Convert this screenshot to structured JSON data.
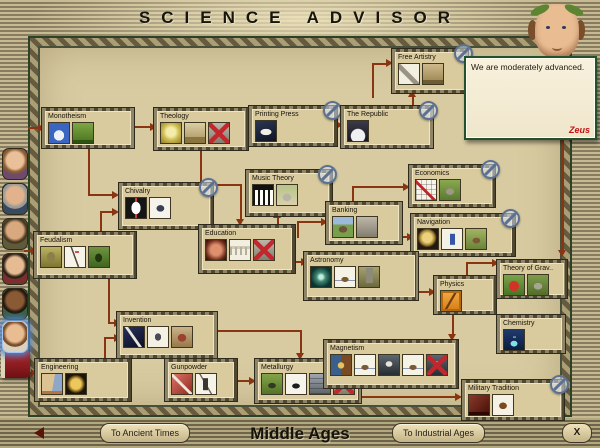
{
  "title": "SCIENCE ADVISOR",
  "era": {
    "current": "Middle Ages",
    "prev_button": "To Ancient Times",
    "next_button": "To Industrial Ages",
    "close_button": "X"
  },
  "advisor": {
    "message": "We are moderately advanced.",
    "link": "Zeus",
    "portrait": "science-advisor-with-laurel-wreath"
  },
  "colors": {
    "arrow": "#8a3512",
    "parchment": "#d8cba1",
    "trim_green": "#2c4226",
    "optional_badge": "#5c7191",
    "link_red": "#c31414"
  },
  "sidebar": {
    "advisors": [
      {
        "name": "domestic-advisor-portrait",
        "y": 148,
        "style": "p1",
        "selected": false
      },
      {
        "name": "trade-advisor-portrait",
        "y": 183,
        "style": "p2",
        "selected": false
      },
      {
        "name": "military-advisor-portrait",
        "y": 218,
        "style": "p3",
        "selected": false
      },
      {
        "name": "foreign-advisor-portrait",
        "y": 253,
        "style": "p4",
        "selected": false
      },
      {
        "name": "cultural-advisor-portrait",
        "y": 288,
        "style": "p5",
        "selected": false
      },
      {
        "name": "science-advisor-portrait",
        "y": 321,
        "style": "p6",
        "selected": true
      }
    ],
    "civilopedia_icon": "red-book-icon"
  },
  "techs": [
    {
      "id": "monotheism",
      "label": "Monotheism",
      "x": 42,
      "y": 108,
      "w": 92,
      "h": 40,
      "optional": false,
      "icons": [
        {
          "n": "cathedral-icon",
          "s": "ic-cathedral"
        },
        {
          "n": "knight-unit-icon",
          "s": "ic-knightg"
        }
      ]
    },
    {
      "id": "theology",
      "label": "Theology",
      "x": 154,
      "y": 108,
      "w": 94,
      "h": 42,
      "optional": false,
      "icons": [
        {
          "n": "statue-icon",
          "s": "ic-statue"
        },
        {
          "n": "sistine-chapel-icon",
          "s": "ic-chapel"
        },
        {
          "n": "unavailable-wonder-icon",
          "s": "ic-gray",
          "x": true
        }
      ]
    },
    {
      "id": "printing-press",
      "label": "Printing Press",
      "x": 249,
      "y": 106,
      "w": 88,
      "h": 40,
      "optional": true,
      "icons": [
        {
          "n": "printing-press-icon",
          "s": "ic-dove"
        }
      ]
    },
    {
      "id": "the-republic",
      "label": "The Republic",
      "x": 341,
      "y": 106,
      "w": 92,
      "h": 42,
      "optional": true,
      "icons": [
        {
          "n": "republic-building-icon",
          "s": "ic-dome"
        }
      ]
    },
    {
      "id": "free-artistry",
      "label": "Free Artistry",
      "x": 392,
      "y": 49,
      "w": 76,
      "h": 44,
      "optional": true,
      "icons": [
        {
          "n": "quill-icon",
          "s": "ic-quillw"
        },
        {
          "n": "theatre-icon",
          "s": "ic-theatre"
        }
      ]
    },
    {
      "id": "chivalry",
      "label": "Chivalry",
      "x": 119,
      "y": 183,
      "w": 94,
      "h": 46,
      "optional": true,
      "icons": [
        {
          "n": "heraldic-shield-icon",
          "s": "ic-shield"
        },
        {
          "n": "knight-horse-icon",
          "s": "ic-horse"
        }
      ]
    },
    {
      "id": "music-theory",
      "label": "Music Theory",
      "x": 246,
      "y": 170,
      "w": 86,
      "h": 46,
      "optional": true,
      "icons": [
        {
          "n": "piano-keys-icon",
          "s": "ic-piano"
        },
        {
          "n": "bach-cathedral-icon",
          "s": "ic-cathg"
        }
      ]
    },
    {
      "id": "banking",
      "label": "Banking",
      "x": 326,
      "y": 202,
      "w": 76,
      "h": 42,
      "optional": false,
      "icons": [
        {
          "n": "bank-icon",
          "s": "ic-bank"
        },
        {
          "n": "stone-building-icon",
          "s": "ic-gray"
        }
      ]
    },
    {
      "id": "economics",
      "label": "Economics",
      "x": 409,
      "y": 165,
      "w": 86,
      "h": 42,
      "optional": true,
      "icons": [
        {
          "n": "stock-chart-icon",
          "s": "ic-chart"
        },
        {
          "n": "trading-company-icon",
          "s": "ic-greenb"
        }
      ]
    },
    {
      "id": "navigation",
      "label": "Navigation",
      "x": 411,
      "y": 214,
      "w": 104,
      "h": 42,
      "optional": true,
      "icons": [
        {
          "n": "sextant-icon",
          "s": "ic-sextant"
        },
        {
          "n": "explorer-unit-icon",
          "s": "ic-explorer"
        },
        {
          "n": "harbor-icon",
          "s": "ic-harbor"
        }
      ]
    },
    {
      "id": "feudalism",
      "label": "Feudalism",
      "x": 34,
      "y": 232,
      "w": 102,
      "h": 46,
      "optional": false,
      "icons": [
        {
          "n": "armor-icon",
          "s": "ic-armor"
        },
        {
          "n": "pikeman-unit-icon",
          "s": "ic-pike"
        },
        {
          "n": "pikemen-field-icon",
          "s": "ic-pikeg"
        }
      ]
    },
    {
      "id": "education",
      "label": "Education",
      "x": 199,
      "y": 225,
      "w": 96,
      "h": 48,
      "optional": false,
      "icons": [
        {
          "n": "knowledge-orb-icon",
          "s": "ic-orb"
        },
        {
          "n": "university-icon",
          "s": "ic-univ"
        },
        {
          "n": "unavailable-wonder-icon",
          "s": "ic-gray",
          "x": true
        }
      ]
    },
    {
      "id": "astronomy",
      "label": "Astronomy",
      "x": 304,
      "y": 252,
      "w": 114,
      "h": 48,
      "optional": false,
      "icons": [
        {
          "n": "galaxy-icon",
          "s": "ic-galaxy"
        },
        {
          "n": "caravel-icon",
          "s": "ic-shipw"
        },
        {
          "n": "observatory-icon",
          "s": "ic-tower"
        }
      ]
    },
    {
      "id": "physics",
      "label": "Physics",
      "x": 434,
      "y": 276,
      "w": 62,
      "h": 38,
      "optional": false,
      "icons": [
        {
          "n": "pendulum-sketch-icon",
          "s": "ic-physics"
        }
      ]
    },
    {
      "id": "theory-of-gravity",
      "label": "Theory of Grav..",
      "x": 497,
      "y": 260,
      "w": 70,
      "h": 38,
      "optional": false,
      "icons": [
        {
          "n": "newton-apple-icon",
          "s": "ic-apple"
        },
        {
          "n": "newton-college-icon",
          "s": "ic-college"
        }
      ]
    },
    {
      "id": "chemistry",
      "label": "Chemistry",
      "x": 497,
      "y": 315,
      "w": 68,
      "h": 38,
      "optional": false,
      "icons": [
        {
          "n": "flask-icon",
          "s": "ic-flask"
        }
      ]
    },
    {
      "id": "invention",
      "label": "Invention",
      "x": 117,
      "y": 312,
      "w": 100,
      "h": 46,
      "optional": false,
      "icons": [
        {
          "n": "quill-night-icon",
          "s": "ic-quilln"
        },
        {
          "n": "flying-machine-icon",
          "s": "ic-flyer"
        },
        {
          "n": "leonardos-workshop-icon",
          "s": "ic-workshop"
        }
      ]
    },
    {
      "id": "engineering",
      "label": "Engineering",
      "x": 35,
      "y": 359,
      "w": 96,
      "h": 42,
      "optional": false,
      "icons": [
        {
          "n": "bridge-sketch-icon",
          "s": "ic-sketch"
        },
        {
          "n": "gold-medal-icon",
          "s": "ic-coin"
        }
      ]
    },
    {
      "id": "gunpowder",
      "label": "Gunpowder",
      "x": 165,
      "y": 359,
      "w": 72,
      "h": 42,
      "optional": false,
      "icons": [
        {
          "n": "saltpeter-icon",
          "s": "ic-gunred"
        },
        {
          "n": "musketman-unit-icon",
          "s": "ic-musket"
        }
      ]
    },
    {
      "id": "metallurgy",
      "label": "Metallurgy",
      "x": 255,
      "y": 359,
      "w": 106,
      "h": 44,
      "optional": false,
      "icons": [
        {
          "n": "cannon-field-icon",
          "s": "ic-cannong"
        },
        {
          "n": "cannon-unit-icon",
          "s": "ic-cannonw"
        },
        {
          "n": "coastal-fortress-icon",
          "s": "ic-wall"
        },
        {
          "n": "unavailable-wonder-icon",
          "s": "ic-gray",
          "x": true
        }
      ]
    },
    {
      "id": "magnetism",
      "label": "Magnetism",
      "x": 324,
      "y": 340,
      "w": 134,
      "h": 48,
      "optional": false,
      "icons": [
        {
          "n": "compass-icon",
          "s": "ic-compass"
        },
        {
          "n": "galleon-icon",
          "s": "ic-shipw"
        },
        {
          "n": "frigate-icon",
          "s": "ic-shipd"
        },
        {
          "n": "privateer-icon",
          "s": "ic-shipw"
        },
        {
          "n": "unavailable-ship-icon",
          "s": "ic-shipd",
          "x": true
        }
      ]
    },
    {
      "id": "military-tradition",
      "label": "Military Tradition",
      "x": 462,
      "y": 380,
      "w": 102,
      "h": 40,
      "optional": true,
      "icons": [
        {
          "n": "military-academy-icon",
          "s": "ic-academy"
        },
        {
          "n": "cavalry-unit-icon",
          "s": "ic-cavalry"
        }
      ]
    }
  ],
  "arrows": {
    "lines": [
      [
        134,
        126,
        18,
        "h"
      ],
      [
        88,
        147,
        48,
        "v"
      ],
      [
        88,
        194,
        26,
        "h"
      ],
      [
        100,
        211,
        22,
        "v"
      ],
      [
        100,
        211,
        14,
        "h"
      ],
      [
        200,
        149,
        36,
        "v"
      ],
      [
        200,
        184,
        42,
        "h"
      ],
      [
        240,
        184,
        36,
        "v"
      ],
      [
        330,
        124,
        8,
        "h"
      ],
      [
        412,
        97,
        10,
        "v"
      ],
      [
        372,
        64,
        34,
        "v"
      ],
      [
        372,
        63,
        16,
        "h"
      ],
      [
        277,
        218,
        9,
        "v"
      ],
      [
        297,
        222,
        16,
        "v"
      ],
      [
        297,
        221,
        26,
        "h"
      ],
      [
        296,
        261,
        7,
        "h"
      ],
      [
        352,
        187,
        16,
        "v"
      ],
      [
        352,
        186,
        53,
        "h"
      ],
      [
        402,
        236,
        7,
        "h"
      ],
      [
        419,
        291,
        12,
        "h"
      ],
      [
        466,
        262,
        15,
        "v"
      ],
      [
        466,
        262,
        28,
        "h"
      ],
      [
        452,
        314,
        21,
        "v"
      ],
      [
        562,
        140,
        112,
        "v"
      ],
      [
        108,
        278,
        45,
        "v"
      ],
      [
        108,
        322,
        8,
        "h"
      ],
      [
        104,
        337,
        23,
        "v"
      ],
      [
        104,
        337,
        12,
        "h"
      ],
      [
        190,
        350,
        7,
        "v"
      ],
      [
        218,
        330,
        82,
        "h"
      ],
      [
        300,
        330,
        25,
        "v"
      ],
      [
        238,
        380,
        13,
        "h"
      ],
      [
        362,
        396,
        95,
        "h"
      ],
      [
        28,
        127,
        12,
        "h"
      ],
      [
        24,
        250,
        9,
        "h"
      ],
      [
        24,
        372,
        9,
        "h"
      ]
    ],
    "heads": [
      [
        150,
        123,
        "r"
      ],
      [
        112,
        191,
        "r"
      ],
      [
        112,
        208,
        "r"
      ],
      [
        236,
        219,
        "d"
      ],
      [
        336,
        121,
        "r"
      ],
      [
        408,
        90,
        "u"
      ],
      [
        386,
        59,
        "r"
      ],
      [
        273,
        211,
        "u"
      ],
      [
        321,
        218,
        "r"
      ],
      [
        301,
        258,
        "r"
      ],
      [
        403,
        183,
        "r"
      ],
      [
        407,
        233,
        "r"
      ],
      [
        429,
        288,
        "r"
      ],
      [
        492,
        259,
        "r"
      ],
      [
        448,
        334,
        "d"
      ],
      [
        558,
        250,
        "d"
      ],
      [
        114,
        319,
        "r"
      ],
      [
        114,
        334,
        "r"
      ],
      [
        186,
        355,
        "d"
      ],
      [
        296,
        353,
        "d"
      ],
      [
        249,
        377,
        "r"
      ],
      [
        455,
        393,
        "r"
      ],
      [
        38,
        124,
        "r"
      ],
      [
        31,
        247,
        "r"
      ],
      [
        31,
        369,
        "r"
      ]
    ]
  }
}
